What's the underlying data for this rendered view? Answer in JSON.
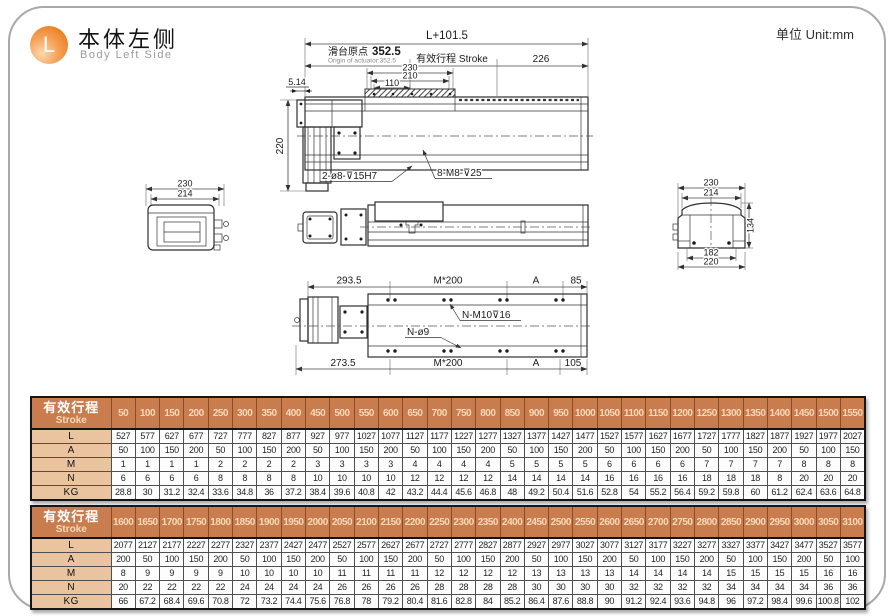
{
  "page": {
    "badge_letter": "L",
    "title_cn": "本体左侧",
    "title_en": "Body Left Side",
    "unit_label": "单位 Unit:mm"
  },
  "colors": {
    "accent_orange": "#ea8124",
    "table_header_bg": "#c97c4e",
    "table_header_text": "#ffffff",
    "table_header_number_text": "#f7d9b8",
    "row_label_bg": "#eac49e",
    "drawing_line": "#2e2e2e"
  },
  "drawing": {
    "top": {
      "dim_total": "L+101.5",
      "origin_cn": "滑台原点",
      "origin_val": "352.5",
      "origin_en": "Origin of actuator:352.5",
      "stroke_label": "有效行程 Stroke",
      "dim_226": "226",
      "dim_230": "230",
      "dim_210": "210",
      "dim_110": "110",
      "dim_514": "5.14",
      "dim_height": "220",
      "label_holes": "2-ø8-⊽15H7",
      "label_screws": "8-M8-⊽25"
    },
    "left_end": {
      "dim_230": "230",
      "dim_214": "214"
    },
    "right_end": {
      "dim_230": "230",
      "dim_214": "214",
      "dim_134": "134",
      "dim_182": "182",
      "dim_220": "220"
    },
    "bottom": {
      "dim_2935": "293.5",
      "dim_m200_top": "M*200",
      "dim_a_top": "A",
      "dim_85": "85",
      "label_m10": "N-M10⊽16",
      "label_o9": "N-ø9",
      "dim_2735": "273.5",
      "dim_m200_bot": "M*200",
      "dim_a_bot": "A",
      "dim_105": "105"
    }
  },
  "tables": [
    {
      "header_label_cn": "有效行程",
      "header_label_en": "Stroke",
      "strokes": [
        50,
        100,
        150,
        200,
        250,
        300,
        350,
        400,
        450,
        500,
        550,
        600,
        650,
        700,
        750,
        800,
        850,
        900,
        950,
        1000,
        1050,
        1100,
        1150,
        1200,
        1250,
        1300,
        1350,
        1400,
        1450,
        1500,
        1550
      ],
      "rows": [
        {
          "label": "L",
          "values": [
            527,
            577,
            627,
            677,
            727,
            777,
            827,
            877,
            927,
            977,
            1027,
            1077,
            1127,
            1177,
            1227,
            1277,
            1327,
            1377,
            1427,
            1477,
            1527,
            1577,
            1627,
            1677,
            1727,
            1777,
            1827,
            1877,
            1927,
            1977,
            2027
          ]
        },
        {
          "label": "A",
          "values": [
            50,
            100,
            150,
            200,
            50,
            100,
            150,
            200,
            50,
            100,
            150,
            200,
            50,
            100,
            150,
            200,
            50,
            100,
            150,
            200,
            50,
            100,
            150,
            200,
            50,
            100,
            150,
            200,
            50,
            100,
            150
          ]
        },
        {
          "label": "M",
          "values": [
            1,
            1,
            1,
            1,
            2,
            2,
            2,
            2,
            3,
            3,
            3,
            3,
            4,
            4,
            4,
            4,
            5,
            5,
            5,
            5,
            6,
            6,
            6,
            6,
            7,
            7,
            7,
            7,
            8,
            8,
            8
          ]
        },
        {
          "label": "N",
          "values": [
            6,
            6,
            6,
            6,
            8,
            8,
            8,
            8,
            10,
            10,
            10,
            10,
            12,
            12,
            12,
            12,
            14,
            14,
            14,
            14,
            16,
            16,
            16,
            16,
            18,
            18,
            18,
            8,
            20,
            20,
            20
          ]
        },
        {
          "label": "KG",
          "values": [
            28.8,
            30,
            31.2,
            32.4,
            33.6,
            34.8,
            36,
            37.2,
            38.4,
            39.6,
            40.8,
            42,
            43.2,
            44.4,
            45.6,
            46.8,
            48,
            49.2,
            50.4,
            51.6,
            52.8,
            54,
            55.2,
            56.4,
            59.2,
            59.8,
            60,
            61.2,
            62.4,
            63.6,
            64.8
          ]
        }
      ]
    },
    {
      "header_label_cn": "有效行程",
      "header_label_en": "Stroke",
      "strokes": [
        1600,
        1650,
        1700,
        1750,
        1800,
        1850,
        1900,
        1950,
        2000,
        2050,
        2100,
        2150,
        2200,
        2250,
        2300,
        2350,
        2400,
        2450,
        2500,
        2550,
        2600,
        2650,
        2700,
        2750,
        2800,
        2850,
        2900,
        2950,
        3000,
        3050,
        3100
      ],
      "rows": [
        {
          "label": "L",
          "values": [
            2077,
            2127,
            2177,
            2227,
            2277,
            2327,
            2377,
            2427,
            2477,
            2527,
            2577,
            2627,
            2677,
            2727,
            2777,
            2827,
            2877,
            2927,
            2977,
            3027,
            3077,
            3127,
            3177,
            3227,
            3277,
            3327,
            3377,
            3427,
            3477,
            3527,
            3577
          ]
        },
        {
          "label": "A",
          "values": [
            200,
            50,
            100,
            150,
            200,
            50,
            100,
            150,
            200,
            50,
            100,
            150,
            200,
            50,
            100,
            150,
            200,
            50,
            100,
            150,
            200,
            50,
            100,
            150,
            200,
            50,
            100,
            150,
            200,
            50,
            100
          ]
        },
        {
          "label": "M",
          "values": [
            8,
            9,
            9,
            9,
            9,
            10,
            10,
            10,
            10,
            11,
            11,
            11,
            11,
            12,
            12,
            12,
            12,
            13,
            13,
            13,
            13,
            14,
            14,
            14,
            14,
            15,
            15,
            15,
            15,
            16,
            16
          ]
        },
        {
          "label": "N",
          "values": [
            20,
            22,
            22,
            22,
            22,
            24,
            24,
            24,
            24,
            26,
            26,
            26,
            26,
            28,
            28,
            28,
            28,
            30,
            30,
            30,
            30,
            32,
            32,
            32,
            32,
            34,
            34,
            34,
            34,
            36,
            36
          ]
        },
        {
          "label": "KG",
          "values": [
            66,
            67.2,
            68.4,
            69.6,
            70.8,
            72,
            73.2,
            74.4,
            75.6,
            76.8,
            78,
            79.2,
            80.4,
            81.6,
            82.8,
            84,
            85.2,
            86.4,
            87.6,
            88.8,
            90,
            91.2,
            92.4,
            93.6,
            94.8,
            96,
            97.2,
            98.4,
            99.6,
            100.8,
            102
          ]
        }
      ]
    }
  ]
}
